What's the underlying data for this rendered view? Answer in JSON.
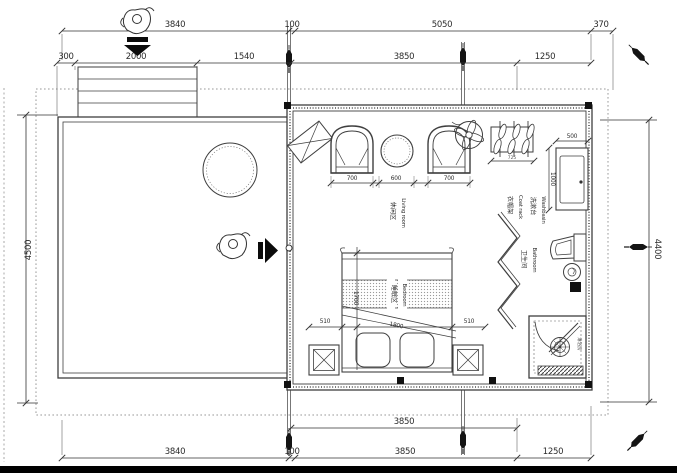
{
  "drawing": {
    "dims_top_row1": [
      "3840",
      "100",
      "5050",
      "370"
    ],
    "dims_top_row2": [
      "300",
      "2000",
      "1540",
      "3850",
      "1250"
    ],
    "dim_left_height": "4500",
    "dim_right_height": "4400",
    "dims_bottom_row1": [
      "3850"
    ],
    "dims_bottom_row2": [
      "3840",
      "100",
      "3850",
      "1250"
    ],
    "dims_living": [
      "700",
      "600",
      "700"
    ],
    "dim_coat_rack_width": "725",
    "dim_washbasin_width": "500",
    "dim_washbasin_depth": "1000",
    "dims_bed": {
      "side_left": "510",
      "side_right": "510",
      "width": "1800",
      "length": "1700"
    },
    "labels": {
      "living": {
        "zh": "休闲区",
        "en": "Living room"
      },
      "bedroom": {
        "zh": "睡眠区",
        "en": "Bedroom"
      },
      "coat_rack": {
        "zh": "衣帽架",
        "en": "Coat rack"
      },
      "washbasin": {
        "zh": "洗漱台",
        "en": "Washbasin"
      },
      "bathroom": {
        "zh": "卫生间",
        "en": "Bathroom"
      },
      "shower": {
        "zh": "淋浴房"
      }
    },
    "icons": {
      "person": "top-view-person-sketch",
      "entry_arrow_down": "solid-down-arrow",
      "entry_arrow_right": "solid-right-arrow",
      "ceiling_fan": "ceiling-fan-four-blades",
      "pen_marker": "black-pen-section-marker",
      "round_table": "circle-table",
      "armchair": "arc-armchair",
      "hanger": "coat-hanger",
      "toilet": "toilet-side",
      "shower_drain": "drain-circle-cross"
    },
    "colors": {
      "line": "#3f3f3f",
      "dotted": "#999999",
      "text": "#2b2b2b",
      "fill": "#ffffff",
      "post": "#111111"
    }
  }
}
